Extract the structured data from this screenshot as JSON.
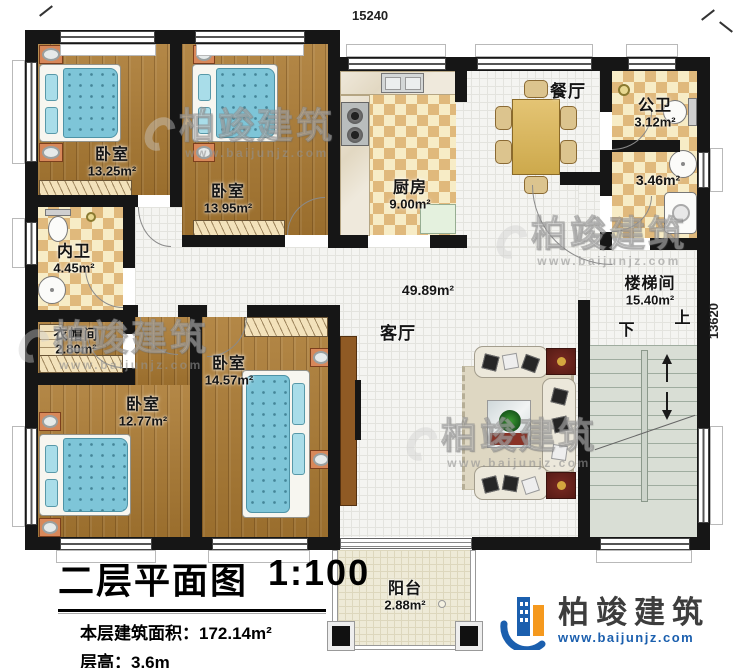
{
  "plan": {
    "dimensions": {
      "top": "15240",
      "right": "13620"
    },
    "rooms": {
      "bedroom1": {
        "name": "卧室",
        "area": "13.25m²"
      },
      "bedroom2": {
        "name": "卧室",
        "area": "13.95m²"
      },
      "inner_bath": {
        "name": "内卫",
        "area": "4.45m²"
      },
      "cloakroom": {
        "name": "衣帽间",
        "area": "2.80m²"
      },
      "bedroom3": {
        "name": "卧室",
        "area": "12.77m²"
      },
      "bedroom4": {
        "name": "卧室",
        "area": "14.57m²"
      },
      "kitchen": {
        "name": "厨房",
        "area": "9.00m²"
      },
      "dining": {
        "name": "餐厅"
      },
      "public_bath": {
        "name": "公卫",
        "area": "3.12m²"
      },
      "wash_area": {
        "area": "3.46m²"
      },
      "living": {
        "name": "客厅",
        "area": "49.89m²"
      },
      "stairwell": {
        "name": "楼梯间",
        "area": "15.40m²",
        "up": "上",
        "down": "下"
      },
      "balcony": {
        "name": "阳台",
        "area": "2.88m²"
      }
    }
  },
  "title_block": {
    "title": "二层平面图",
    "scale": "1:100",
    "floor_area_label": "本层建筑面积：",
    "floor_area_value": "172.14m²",
    "floor_height_label": "层高：",
    "floor_height_value": "3.6m"
  },
  "branding": {
    "watermark_text": "柏竣建筑",
    "watermark_url": "www.baijunjz.com",
    "logo_text": "柏竣建筑",
    "logo_url": "www.baijunjz.com",
    "colors": {
      "logo_blue": "#1b5fae",
      "logo_orange": "#f5991e",
      "wall_black": "#161616",
      "wood_floor": "#ab7a32"
    }
  }
}
